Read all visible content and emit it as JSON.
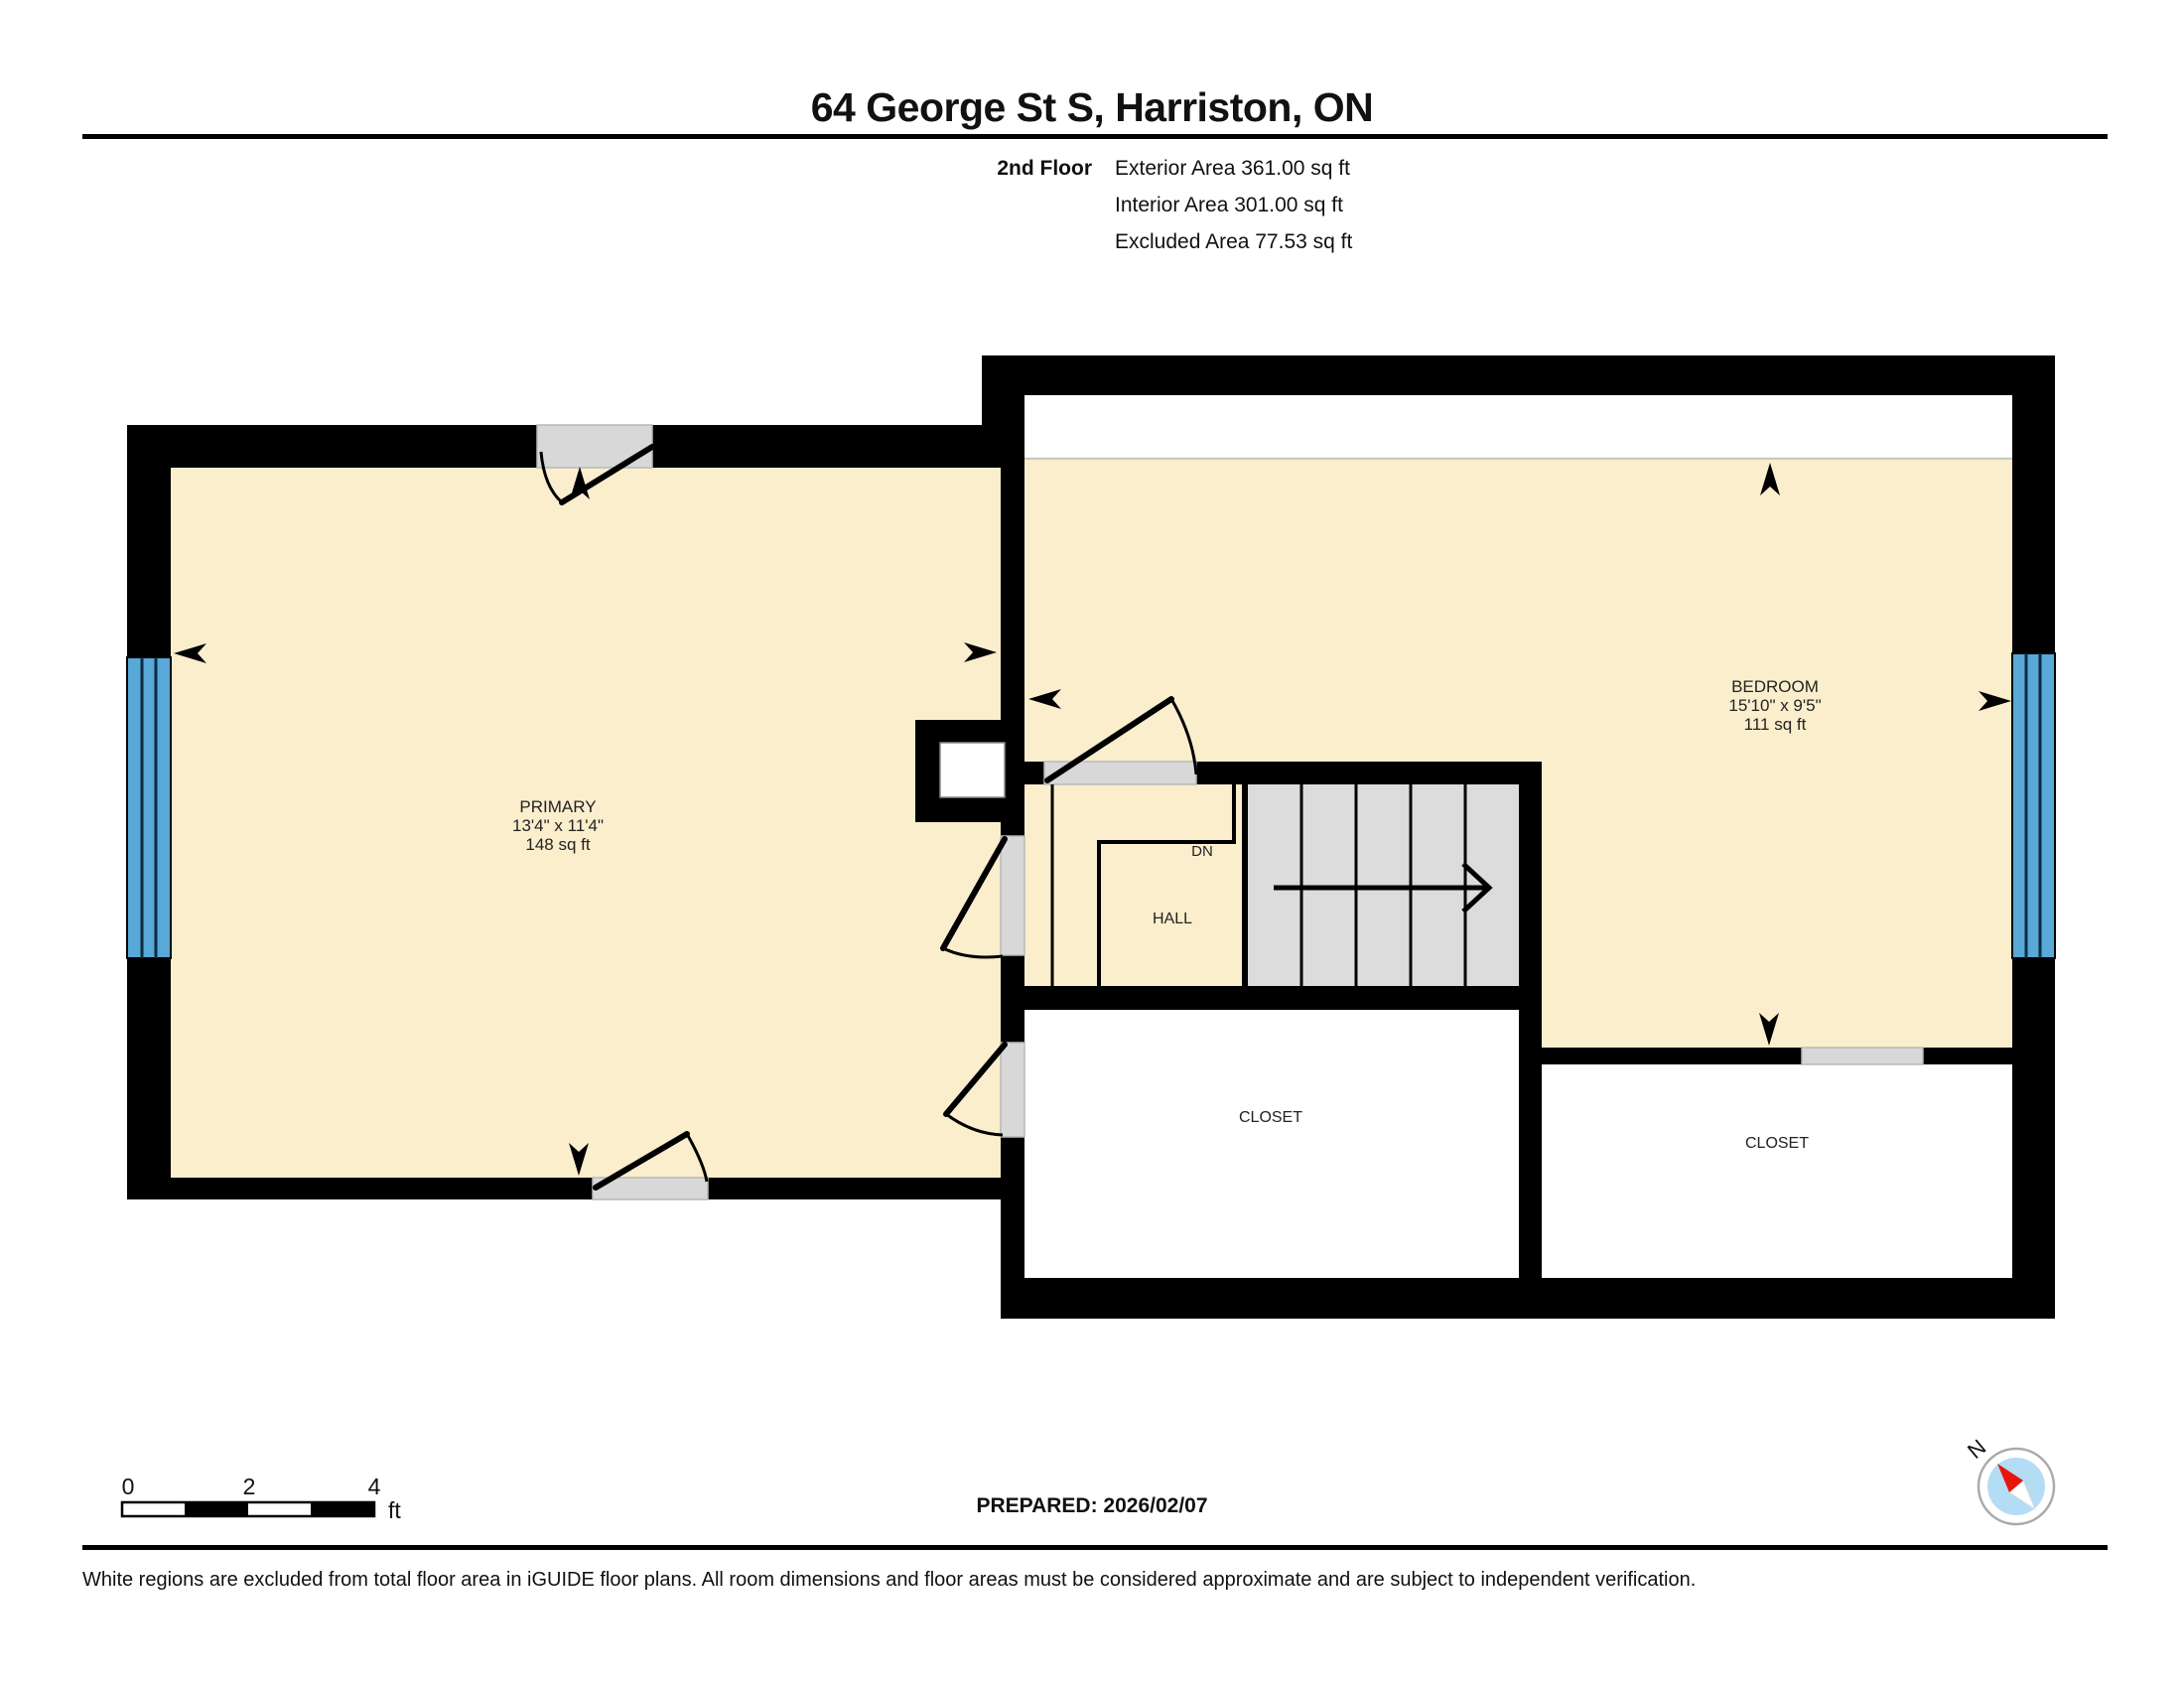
{
  "page": {
    "title": "64 George St S, Harriston, ON"
  },
  "floor_info": {
    "floor_label": "2nd Floor",
    "exterior_area": "Exterior Area 361.00 sq ft",
    "interior_area": "Interior Area 301.00 sq ft",
    "excluded_area": "Excluded Area 77.53 sq ft"
  },
  "rooms": {
    "primary": {
      "name": "PRIMARY",
      "dimensions": "13'4\" x 11'4\"",
      "area": "148 sq ft"
    },
    "bedroom": {
      "name": "BEDROOM",
      "dimensions": "15'10\" x 9'5\"",
      "area": "111 sq ft"
    },
    "hall": {
      "name": "HALL"
    },
    "stairs": {
      "down_label": "DN"
    },
    "closet_center": {
      "name": "CLOSET"
    },
    "closet_right": {
      "name": "CLOSET"
    }
  },
  "scale_bar": {
    "ticks": [
      "0",
      "2",
      "4"
    ],
    "unit": "ft"
  },
  "prepared_label": "PREPARED: 2026/02/07",
  "compass": {
    "north_label": "N"
  },
  "disclaimer": "White regions are excluded from total floor area in iGUIDE floor plans. All room dimensions and floor areas must be considered approximate and are subject to independent verification.",
  "colors": {
    "wall": "#000000",
    "room_fill": "#FAEECD",
    "excluded_fill": "#FFFFFF",
    "opening_fill": "#D8D8D8",
    "stair_fill": "#DCDCDC",
    "window_fill": "#58A8D8",
    "compass_face": "#B5DCF5",
    "compass_needle": "#E8150D"
  }
}
